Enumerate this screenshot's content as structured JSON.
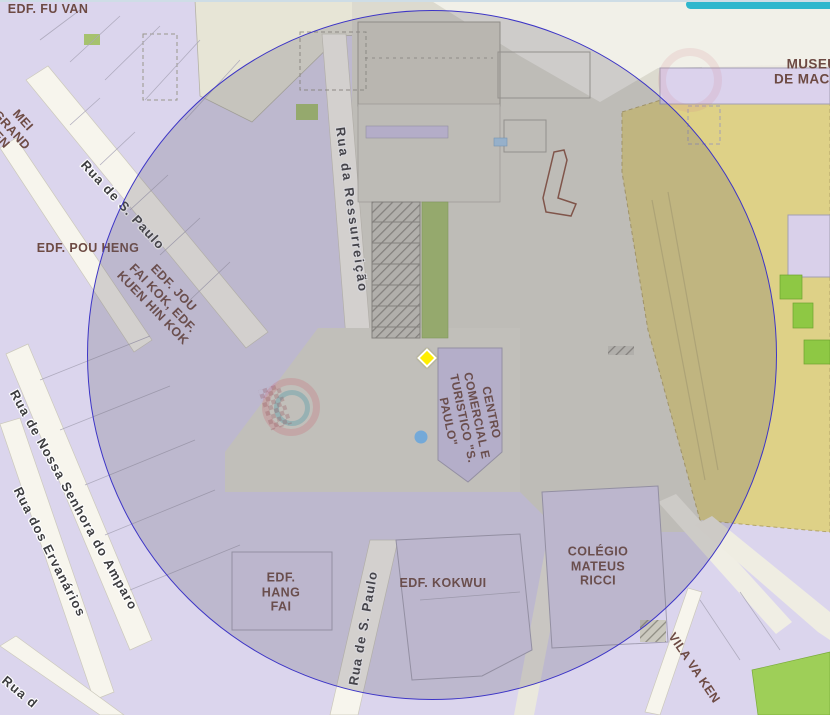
{
  "map_labels": {
    "buildings": [
      {
        "text": "EDF. FU VAN"
      },
      {
        "lines": [
          "MEI",
          "GRAND",
          "EN"
        ]
      },
      {
        "text": "EDF. POU HENG"
      },
      {
        "lines": [
          "EDF. JOU",
          "FAI KOK, EDF.",
          "KUEN HIN KOK"
        ]
      },
      {
        "lines": [
          "EDF.",
          "HANG",
          "FAI"
        ]
      },
      {
        "text": "EDF. KOKWUI"
      },
      {
        "lines": [
          "COLÉGIO",
          "MATEUS",
          "RICCI"
        ]
      },
      {
        "text": "VILA VA KEN"
      },
      {
        "lines": [
          "MUSEU",
          "DE MACAU"
        ]
      },
      {
        "lines": [
          "CENTRO",
          "COMERCIAL E",
          "TURISTICO \"S.",
          "PAULO\""
        ]
      }
    ],
    "streets": [
      {
        "text": "Rua de S. Paulo"
      },
      {
        "text": "Rua da Ressurreição"
      },
      {
        "text": "Rua de Nossa Senhora do Amparo"
      },
      {
        "text": "Rua dos Ervanários"
      },
      {
        "text": "Rua de S. Paulo"
      },
      {
        "text": "Rua d"
      }
    ]
  },
  "overlays": {
    "buffer_circle": {
      "outline_color": "#3d35c6",
      "fill_color": "rgba(97,94,109,0.24)"
    }
  },
  "markers": {
    "selected_location": {
      "shape": "diamond",
      "color": "#ffee00"
    },
    "poi_dot": {
      "shape": "circle",
      "color": "#74a9d8"
    }
  },
  "colors": {
    "building_fill": "#dbd5ed",
    "building_label": "#6d4a43",
    "street_label": "#3d3d40",
    "green_area": "#a6c26e",
    "bright_green_area": "#8ec844",
    "hill_area": "#ded187",
    "road": "#f7f5ed",
    "watermark_cyan": "#2fb7cd"
  }
}
